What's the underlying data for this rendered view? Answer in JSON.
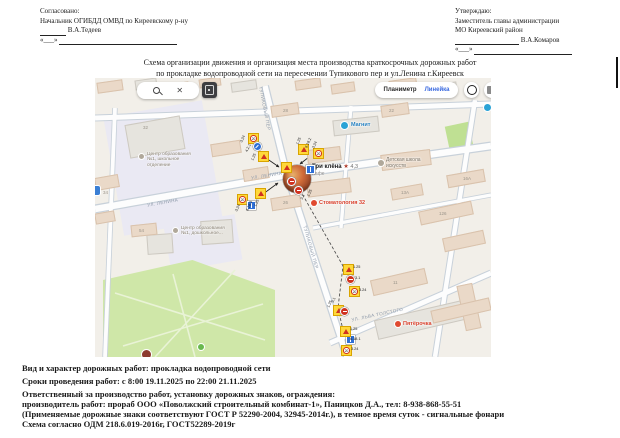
{
  "approvals": {
    "left": {
      "heading": "Согласовано:",
      "title_line": "Начальник ОГИБДД ОМВД по Киреевскому р-ну",
      "name": "В.А.Тедеев",
      "date_prefix": "«___»"
    },
    "right": {
      "heading": "Утверждаю:",
      "title_line1": "Заместитель главы администрации",
      "title_line2": "МО Киреевский район",
      "name": "В.А.Комаров",
      "date_prefix": "«___»"
    }
  },
  "title": {
    "line1": "Схема организации движения и организация места производства краткосрочных дорожных работ",
    "line2": "по прокладке водопроводной сети на пересечении Тупикового пер и ул.Ленина г.Киреевск"
  },
  "map": {
    "toolbar": {
      "planimeter": "Планиметр",
      "ruler": "Линейка",
      "close": "✕"
    },
    "streets": {
      "tupikovy": "Тупиковый пер",
      "lenina": "ул. Ленина",
      "lva_tolstogo": "ул. Льва Толстого"
    },
    "pois": {
      "magnit": "Магнит",
      "cafe_name": "Три клёна",
      "cafe_star": "★",
      "cafe_rating": "4,3",
      "cafe_category": "Кафе",
      "art_school_l1": "Детская школа",
      "art_school_l2": "искусств",
      "dental": "Стоматология 32",
      "pyaterochka": "Пятёрочка",
      "edu_school": "Центр образования №1, школьное отделение",
      "edu_preschool": "Центр образования №1, дошкольное..."
    },
    "house_numbers": [
      "32",
      "34",
      "28",
      "22",
      "26",
      "54",
      "11",
      "13А",
      "16А",
      "126"
    ],
    "signs": {
      "speed_value": "20",
      "a": [
        "3.24",
        "4.2.1",
        "1.25"
      ],
      "b": [
        "3.1",
        "1.25"
      ],
      "c": [
        "3.24",
        "6.18.3",
        "1.25"
      ],
      "d": [
        "1.25",
        "3.1",
        "3.24"
      ],
      "e": [
        "1.25",
        "3.1"
      ],
      "f": [
        "1.25",
        "6.18.1",
        "3.24"
      ],
      "g": [
        "1.25",
        "6.18.2",
        "3.24"
      ]
    }
  },
  "details": {
    "line1": "Вид и характер дорожных работ: прокладка водопроводной сети",
    "line2": "Сроки проведения работ: с 8:00 19.11.2025 по 22:00 21.11.2025",
    "line3": "Ответственный за производство работ, установку дорожных знаков, ограждения:",
    "line4": "производитель работ: прораб ООО «Поволжский строительный комбинат-1», Паницков Д.А., тел: 8-938-868-55-51",
    "line5": "(Применяемые дорожные знаки соответствуют ГОСТ Р 52290-2004, 32945-2014г.), в темное время суток - сигнальные фонари",
    "line6": "Схема согласно ОДМ 218.6.019-2016г,  ГОСТ52289-2019г"
  }
}
